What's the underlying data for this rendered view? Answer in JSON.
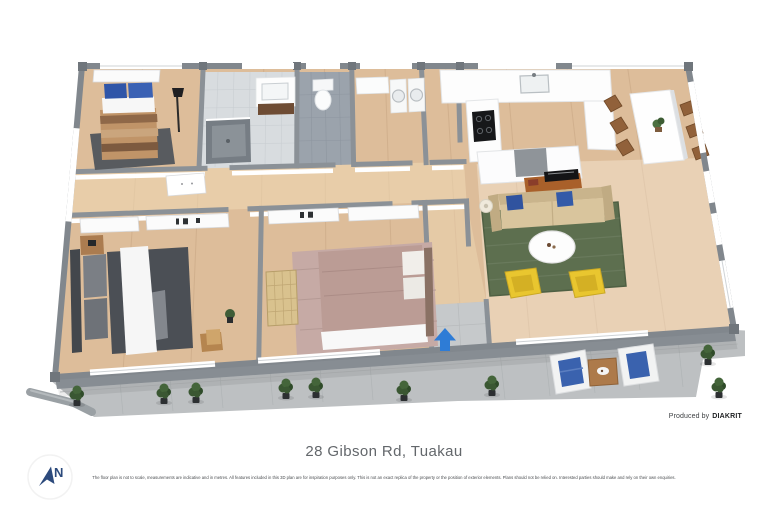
{
  "page": {
    "background": "#ffffff"
  },
  "floor_plan": {
    "type": "3d-floor-plan",
    "compass": {
      "label": "N",
      "color": "#2c4a7c"
    },
    "credit": {
      "prefix": "Produced by",
      "brand": "DIAKRIT"
    },
    "visible_rooms": [
      "bedroom-1",
      "bathroom",
      "toilet",
      "laundry",
      "kitchen",
      "dining-area",
      "living-room",
      "bedroom-2",
      "bedroom-3",
      "hallway",
      "entry",
      "patio",
      "walkway"
    ],
    "visible_features": [
      "entry-arrow",
      "outdoor-armchairs",
      "outdoor-side-table",
      "potted-shrubs",
      "downpipe",
      "wall-windows"
    ],
    "colors": {
      "floor_wood": "#ddbd9a",
      "walls": "#868c92",
      "entry_arrow": "#2e7cd6",
      "living_rug": "#5d6f4f",
      "armchairs": "#e9c62f",
      "cushions": "#335aa8",
      "concrete": "#bdc0c2"
    }
  },
  "caption": {
    "title": "28 Gibson Rd, Tuakau"
  },
  "disclaimer": {
    "text": "The floor plan is not to scale, measurements are indicative and in metres. All features included in this 3D plan are for inspiration purposes only. This is not an exact replica of the property or the position of exterior elements. Plans should not be relied on. Interested parties should make and rely on their own enquiries."
  }
}
